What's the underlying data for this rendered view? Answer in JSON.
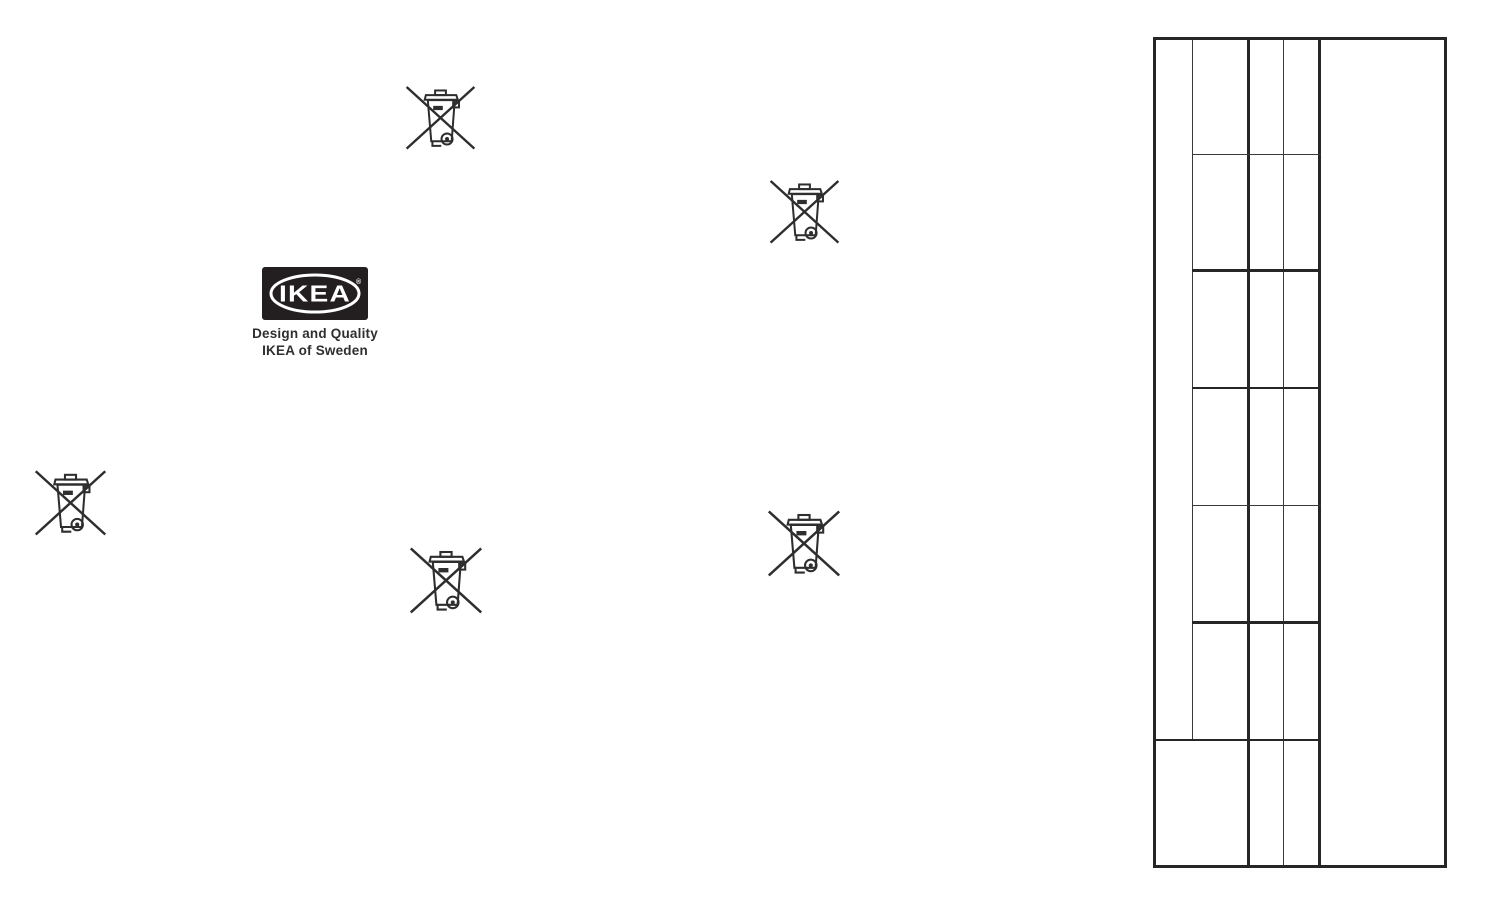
{
  "document": {
    "kind": "scanned instruction back page",
    "background": "#ffffff"
  },
  "logo": {
    "brand": "IKEA",
    "registered_mark": "®",
    "tagline": [
      "Design and Quality",
      "IKEA of Sweden"
    ],
    "colors": {
      "logo_black": "#231f20",
      "logo_white": "#ffffff"
    }
  },
  "icons": {
    "weee_bin": {
      "name": "weee-crossed-out-wheelie-bin-icon",
      "meaning": "do not dispose of in household waste",
      "color": "#2e2e2e",
      "count": 5,
      "instances": [
        {
          "left": 402,
          "top": 77,
          "size": 77
        },
        {
          "left": 766,
          "top": 171,
          "size": 77
        },
        {
          "left": 31,
          "top": 461,
          "size": 79
        },
        {
          "left": 406,
          "top": 538,
          "size": 80
        },
        {
          "left": 764,
          "top": 501,
          "size": 80
        }
      ]
    }
  },
  "table": {
    "line_color": "#262626",
    "columns": 5,
    "middle_rows": 7,
    "content": "empty grid (no text)"
  }
}
